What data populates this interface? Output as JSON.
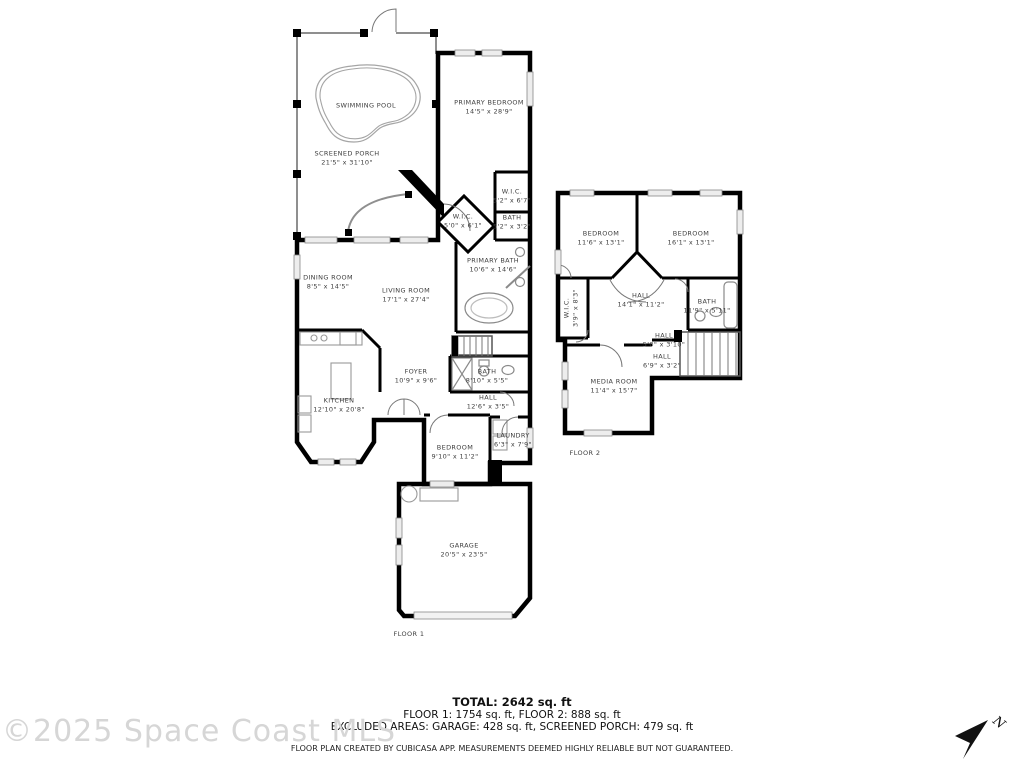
{
  "watermark": "©2025 Space Coast MLS",
  "north_indicator": "N",
  "colors": {
    "wall": "#000000",
    "background": "#ffffff",
    "watermark": "#d6d6d6",
    "window": "#ededed"
  },
  "floor1": {
    "label": "FLOOR 1",
    "rooms": [
      {
        "name": "SWIMMING POOL",
        "dims": ""
      },
      {
        "name": "SCREENED PORCH",
        "dims": "21'5\" x 31'10\""
      },
      {
        "name": "PRIMARY BEDROOM",
        "dims": "14'5\" x 28'9\""
      },
      {
        "name": "W.I.C.",
        "dims": "5'2\" x 6'7\""
      },
      {
        "name": "BATH",
        "dims": "5'2\" x 3'2\""
      },
      {
        "name": "W.I.C.",
        "dims": "5'0\" x 6'1\""
      },
      {
        "name": "PRIMARY BATH",
        "dims": "10'6\" x 14'6\""
      },
      {
        "name": "DINING ROOM",
        "dims": "8'5\" x 14'5\""
      },
      {
        "name": "LIVING ROOM",
        "dims": "17'1\" x 27'4\""
      },
      {
        "name": "KITCHEN",
        "dims": "12'10\" x 20'8\""
      },
      {
        "name": "FOYER",
        "dims": "10'9\" x 9'6\""
      },
      {
        "name": "BATH",
        "dims": "8'10\" x 5'5\""
      },
      {
        "name": "HALL",
        "dims": "12'6\" x 3'5\""
      },
      {
        "name": "BEDROOM",
        "dims": "9'10\" x 11'2\""
      },
      {
        "name": "LAUNDRY",
        "dims": "6'3\" x 7'9\""
      },
      {
        "name": "GARAGE",
        "dims": "20'5\" x 23'5\""
      }
    ]
  },
  "floor2": {
    "label": "FLOOR 2",
    "rooms": [
      {
        "name": "BEDROOM",
        "dims": "11'6\" x 13'1\""
      },
      {
        "name": "BEDROOM",
        "dims": "16'1\" x 13'1\""
      },
      {
        "name": "W.I.C.",
        "dims": "3'9\" x 8'3\""
      },
      {
        "name": "HALL",
        "dims": "14'1\" x 11'2\""
      },
      {
        "name": "BATH",
        "dims": "11'9\" x 5'11\""
      },
      {
        "name": "HALL",
        "dims": "5'0\" x 3'10\""
      },
      {
        "name": "HALL",
        "dims": "6'9\" x 3'2\""
      },
      {
        "name": "MEDIA ROOM",
        "dims": "11'4\" x 15'7\""
      }
    ]
  },
  "summary": {
    "total": "TOTAL: 2642 sq. ft",
    "floors": "FLOOR 1: 1754 sq. ft, FLOOR 2: 888 sq. ft",
    "excluded": "EXCLUDED AREAS: GARAGE: 428 sq. ft, SCREENED PORCH: 479 sq. ft",
    "disclaimer": "FLOOR PLAN CREATED BY CUBICASA APP. MEASUREMENTS DEEMED HIGHLY RELIABLE BUT NOT GUARANTEED."
  }
}
